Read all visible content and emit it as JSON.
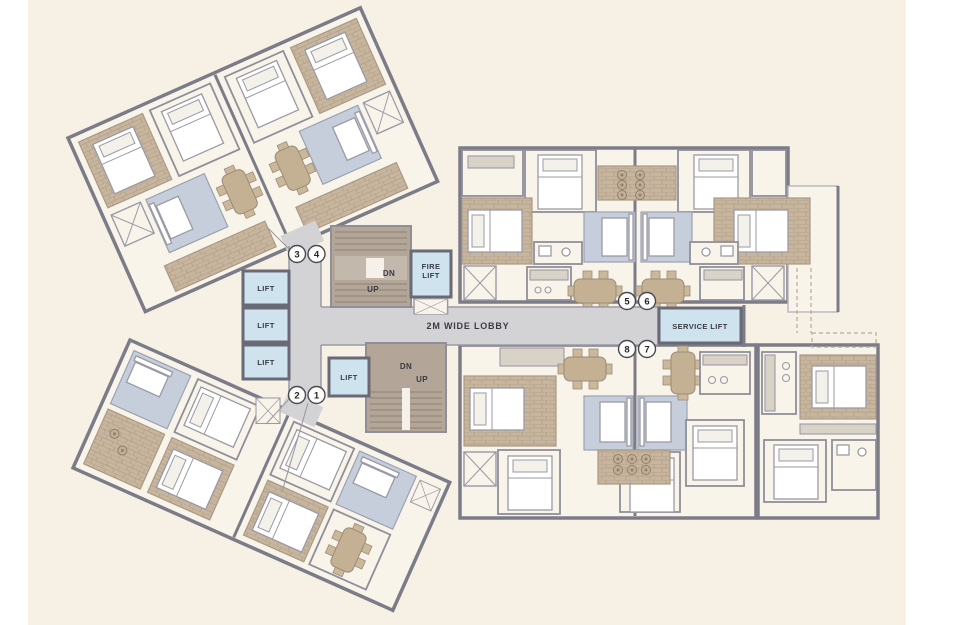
{
  "plan": {
    "type": "residential-tower-floor-plan",
    "lobby": {
      "label": "2M WIDE LOBBY"
    },
    "lifts": {
      "bank": [
        "LIFT",
        "LIFT",
        "LIFT"
      ],
      "single": "LIFT",
      "fire": [
        "FIRE",
        "LIFT"
      ],
      "service": "SERVICE LIFT"
    },
    "stairs": {
      "upper": {
        "dn": "DN",
        "up": "UP"
      },
      "lower": {
        "dn": "DN",
        "up": "UP"
      }
    },
    "markers": {
      "top_left": [
        "3",
        "4"
      ],
      "bottom_left": [
        "2",
        "1"
      ],
      "right_top": [
        "5",
        "6"
      ],
      "right_bottom": [
        "8",
        "7"
      ]
    },
    "colors": {
      "page-bg": "#ffffff",
      "plan-bg": "#f6f0e5",
      "room": "#f9f4ea",
      "wall": "#7c7c88",
      "lift": "#cfe3ee",
      "lobby-fill": "#d3d3d6",
      "stair": "#b3a698",
      "wood": "#c8b59e",
      "sofa": "#c7cedb",
      "ink": "#3a3a44"
    }
  }
}
